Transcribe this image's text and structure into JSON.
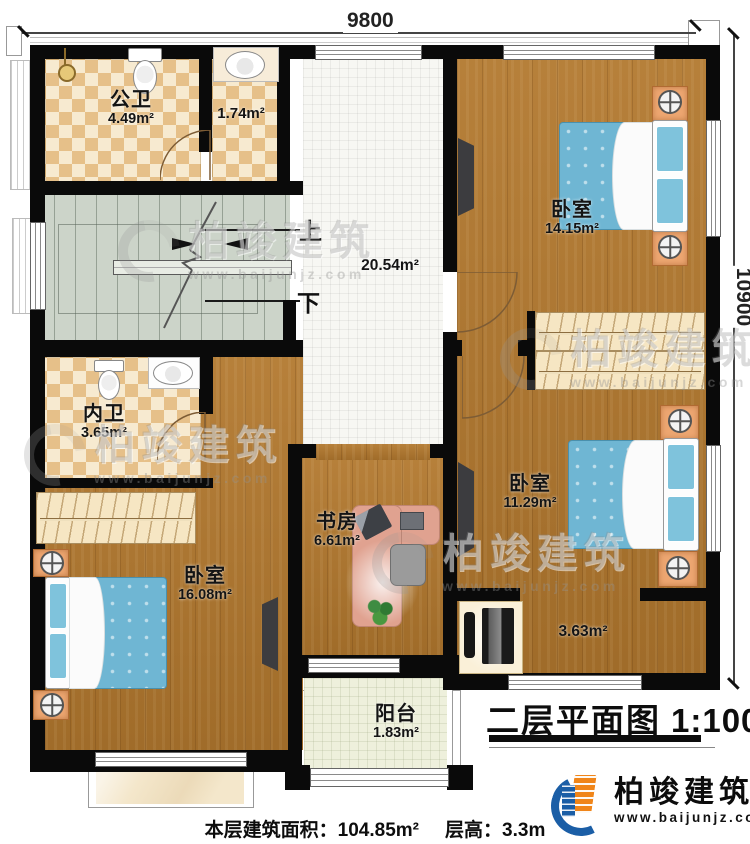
{
  "dimensions": {
    "top": "9800",
    "right": "10900"
  },
  "stairs": {
    "up": "上",
    "down": "下"
  },
  "hall": {
    "area": "20.54m²"
  },
  "rooms": {
    "public_bath": {
      "name": "公卫",
      "area": "4.49m²"
    },
    "small_bath": {
      "area": "1.74m²"
    },
    "bedroom_top_right": {
      "name": "卧室",
      "area": "14.15m²"
    },
    "private_bath": {
      "name": "内卫",
      "area": "3.65m²"
    },
    "bedroom_right": {
      "name": "卧室",
      "area": "11.29m²"
    },
    "bedroom_left": {
      "name": "卧室",
      "area": "16.08m²"
    },
    "study": {
      "name": "书房",
      "area": "6.61m²"
    },
    "corridor": {
      "area": "3.63m²"
    },
    "balcony": {
      "name": "阳台",
      "area": "1.83m²"
    }
  },
  "title": {
    "text": "二层平面图",
    "scale": "1:100"
  },
  "footer": {
    "area_label": "本层建筑面积：",
    "area_value": "104.85m²",
    "height_label": "层高：",
    "height_value": "3.3m"
  },
  "brand": {
    "name": "柏竣建筑",
    "url": "www.baijunjz.com",
    "blue": "#1b5ea6",
    "orange": "#f08519"
  },
  "watermark": {
    "name": "柏竣建筑",
    "url": "www.baijunjz.com"
  }
}
